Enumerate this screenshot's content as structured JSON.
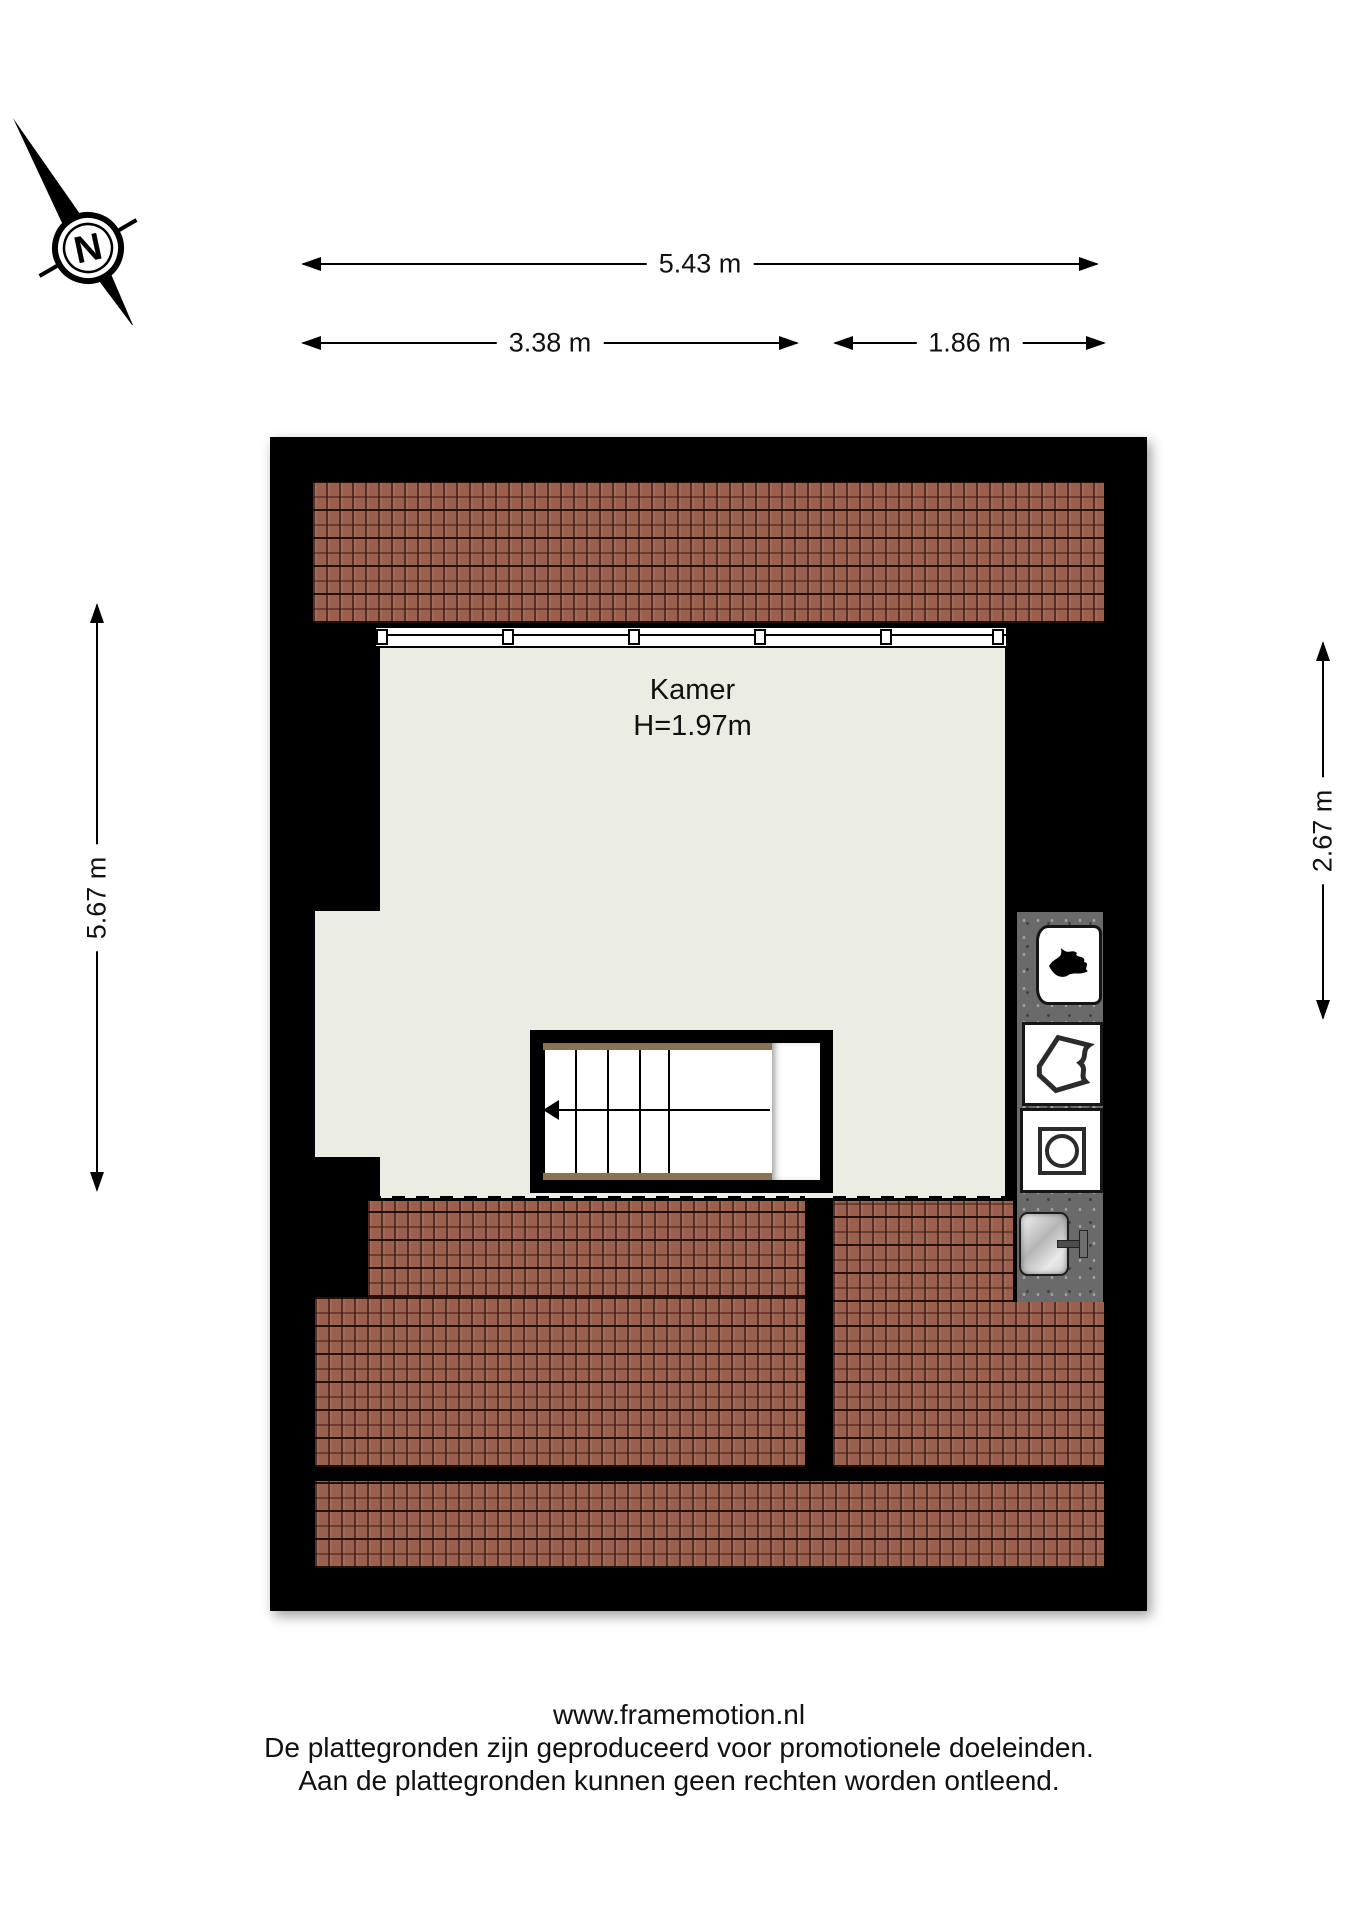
{
  "compass": {
    "north_label": "N"
  },
  "dimensions": {
    "top_total": "5.43 m",
    "top_left_segment": "3.38 m",
    "top_right_segment": "1.86 m",
    "left_vertical": "5.67 m",
    "right_vertical": "2.67 m"
  },
  "room": {
    "name": "Kamer",
    "ceiling_height": "H=1.97m"
  },
  "fixtures": {
    "boiler": "flame-icon",
    "basket": "laundry-appliance-icon",
    "washer": "washing-machine-icon",
    "sink": "sink-with-faucet"
  },
  "footer": {
    "line1": "www.framemotion.nl",
    "line2": "De plattegronden zijn geproduceerd voor promotionele doeleinden.",
    "line3": "Aan de plattegronden kunnen geen rechten worden ontleend."
  },
  "colors": {
    "wall": "#000000",
    "floor": "#ebece2",
    "roof": "#9a5f4d",
    "counter": "#6a6a6a"
  }
}
